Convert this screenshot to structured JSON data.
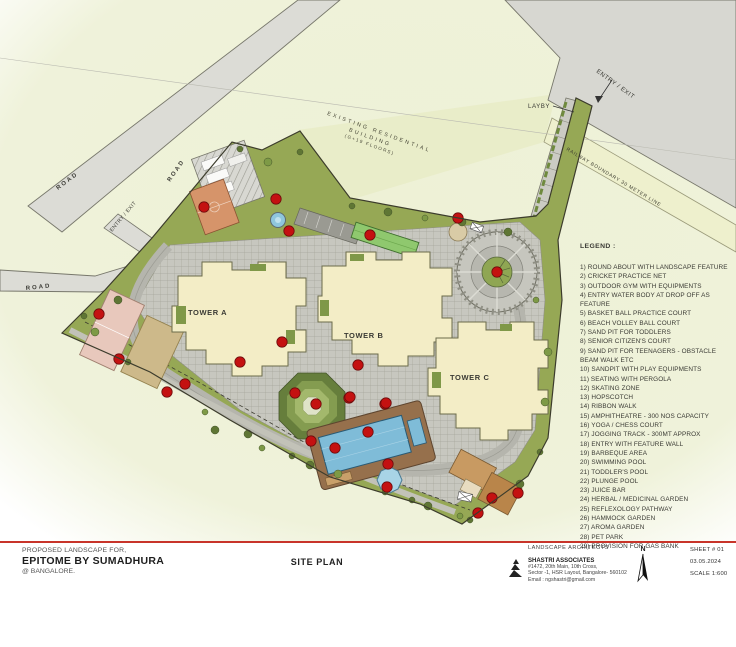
{
  "plan": {
    "labels": {
      "tower_a": "TOWER A",
      "tower_b": "TOWER B",
      "tower_c": "TOWER C",
      "road1": "ROAD",
      "road1b": "ROAD",
      "road2": "ROAD",
      "entry_exit_left": "ENTRY / EXIT",
      "entry_exit_top": "ENTRY / EXIT",
      "layby": "LAYBY",
      "existing_line1": "EXISTING RESIDENTIAL",
      "existing_line2": "BUILDING",
      "existing_line3": "(G+19 FLOORS)",
      "railway": "RAILWAY BOUNDARY 30 METER LINE"
    }
  },
  "legend": {
    "title": "LEGEND :",
    "items": [
      "1)  ROUND ABOUT WITH LANDSCAPE FEATURE",
      "2) CRICKET PRACTICE NET",
      "3) OUTDOOR GYM WITH EQUIPMENTS",
      "4) ENTRY WATER BODY AT DROP OFF AS FEATURE",
      "5) BASKET BALL PRACTICE COURT",
      "6) BEACH VOLLEY BALL COURT",
      "7) SAND PIT FOR TODDLERS",
      "8) SENIOR CITIZEN'S COURT",
      "9) SAND PIT FOR TEENAGERS - OBSTACLE BEAM WALK ETC",
      "10) SANDPIT WITH PLAY EQUIPMENTS",
      "11) SEATING WITH PERGOLA",
      "12) SKATING ZONE",
      "13) HOPSCOTCH",
      "14) RIBBON WALK",
      "15) AMPHITHEATRE - 300 NOS CAPACITY",
      "16) YOGA / CHESS COURT",
      "17) JOGGING TRACK - 300MT APPROX",
      "18) ENTRY WITH FEATURE WALL",
      "19) BARBEQUE AREA",
      "20) SWIMMING POOL",
      "21) TODDLER'S POOL",
      "22) PLUNGE POOL",
      "23) JUICE BAR",
      "24) HERBAL / MEDICINAL GARDEN",
      "25) REFLEXOLOGY PATHWAY",
      "26) HAMMOCK GARDEN",
      "27) AROMA GARDEN",
      "28) PET PARK",
      "29) PROVISION FOR GAS BANK"
    ]
  },
  "titleblock": {
    "project_label": "PROPOSED LANDSCAPE FOR,",
    "project_name": "EPITOME BY SUMADHURA",
    "project_location": "@ BANGALORE.",
    "drawing_title": "SITE PLAN",
    "architect_type": "LANDSCAPE ARCHITECTS",
    "firm": "SHASTRI ASSOCIATES",
    "address1": "#1472, 20th Main, 10th Cross,",
    "address2": "Sector -1, HSR Layout, Bangalore- 560102",
    "email": "Email : ngshastri@gmail.com",
    "north": "N",
    "sheet": "SHEET # 01",
    "date": "03.05.2024",
    "scale": "SCALE 1:600"
  },
  "colors": {
    "accent_red": "#c8342a",
    "lawn": "#96a855",
    "building_cream": "#f3edc6",
    "pool_blue": "#7fbcd8",
    "marker_red": "#c41111"
  }
}
